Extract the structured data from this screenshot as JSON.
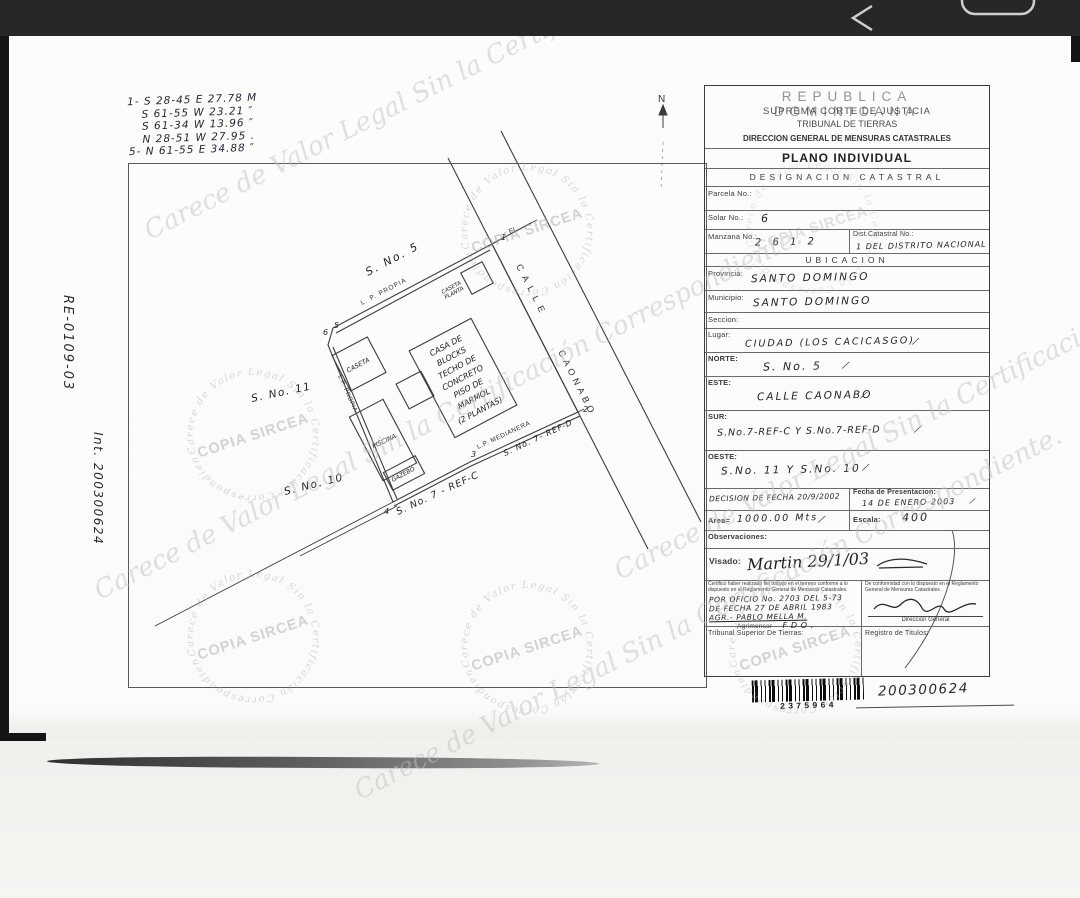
{
  "survey": {
    "lines": [
      "1- S 28-45 E  27.78 M",
      "S 61-55 W  23.21 ″",
      "S 61-34 W  13.96 ″",
      "N 28-51 W  27.95 .",
      "5- N 61-55 E  34.88 ″"
    ]
  },
  "margin": {
    "expediente": "RE-0109-03",
    "interno": "Int. 200300624"
  },
  "plan": {
    "north_label": "N",
    "street_name_1": "CALLE",
    "street_name_2": "CAONABO",
    "neighbors": {
      "north": "S. No. 5",
      "west_1": "S. No. 11",
      "west_2": "S. No. 10",
      "south_c": "S. No. 7 - REF-C",
      "south_d": "S. No. 7- REF-D"
    },
    "boundaries": {
      "top": "L. P. PROPIA",
      "left": "L.P. PROPIA",
      "south": "L.P. MEDIANERA",
      "corner_note": "EL"
    },
    "corners": [
      "1",
      "2",
      "3",
      "4",
      "5",
      "6"
    ],
    "casa_lines": [
      "CASA DE",
      "BLOCKS",
      "TECHO DE",
      "CONCRETO",
      "PISO DE",
      "MARMOL",
      "(2 PLANTAS)"
    ],
    "caseta": "CASETA",
    "piscina": "PISCINA",
    "gazebo": "GAZEBO",
    "caseta_planta": [
      "CASETA",
      "PLANTA"
    ]
  },
  "form": {
    "header": [
      "REPUBLICA DOMINICANA",
      "SUPREMA CORTE DE JUSTICIA",
      "TRIBUNAL DE TIERRAS",
      "DIRECCION GENERAL DE MENSURAS CATASTRALES"
    ],
    "title": "PLANO INDIVIDUAL",
    "subtitle": "DESIGNACION CATASTRAL",
    "tick": "∕",
    "parcela": {
      "label": "Parcela No.:",
      "value": ""
    },
    "solar": {
      "label": "Solar No.:",
      "value": "6"
    },
    "manzana": {
      "label": "Manzana No.:",
      "value": "2 6 1 2"
    },
    "dist": {
      "label": "Dist.Catastral No.:",
      "value": "1 DEL DISTRITO NACIONAL"
    },
    "ubicacion_title": "UBICACION",
    "provincia": {
      "label": "Provincia:",
      "value": "SANTO DOMINGO"
    },
    "municipio": {
      "label": "Municipio:",
      "value": "SANTO DOMINGO"
    },
    "seccion": {
      "label": "Seccion:",
      "value": ""
    },
    "lugar": {
      "label": "Lugar:",
      "value": "CIUDAD (LOS CACICASGO)"
    },
    "norte": {
      "label": "NORTE:",
      "value": "S.  No.  5"
    },
    "este": {
      "label": "ESTE:",
      "value": "CALLE CAONABO"
    },
    "sur": {
      "label": "SUR:",
      "value": "S.No.7-REF-C  Y S.No.7-REF-D"
    },
    "oeste": {
      "label": "OESTE:",
      "value": "S.No. 11   Y   S.No. 10"
    },
    "decision": {
      "value": "DECISION DE FECHA 20/9/2002"
    },
    "fecha_presentacion": {
      "label": "Fecha de Presentacion:",
      "value": "14 DE ENERO 2003"
    },
    "area": {
      "label": "Area=",
      "value": "1000.00 Mts"
    },
    "escala": {
      "label": "Escala:",
      "value": "400"
    },
    "observaciones": {
      "label": "Observaciones:"
    },
    "visado": {
      "label": "Visado:",
      "value": "Martin  29/1/03"
    },
    "cert_left": "Certifico haber realizado fiel trabajo en el terreno conforme a lo dispuesto en el Reglamento General de Mensuras Catastrales.",
    "cert_right": "De conformidad con lo dispuesto en el Reglamento General de Mensuras Catastrales.",
    "oficio_lines": [
      "POR OFICIO No. 2703 DEL 5-73",
      "DE FECHA 27 DE ABRIL 1983",
      "AGR.- PABLO MELLA M."
    ],
    "agrimensor": {
      "label": "Agrimensor",
      "value": "F D O ."
    },
    "direccion_general": "Direccion General",
    "tribunal_superior": "Tribunal Superior De Tierras:",
    "registro_titulos": "Registro de Titulos:"
  },
  "barcode": {
    "number": "2375964",
    "written_number": "200300624"
  },
  "watermark": {
    "stamp": "COPIA SIRCEA",
    "ring": "Carece de Valor Legal Sin la Certificación Correspondiente.",
    "script": "Carece de Valor Legal Sin la Certificación Correspondiente."
  }
}
